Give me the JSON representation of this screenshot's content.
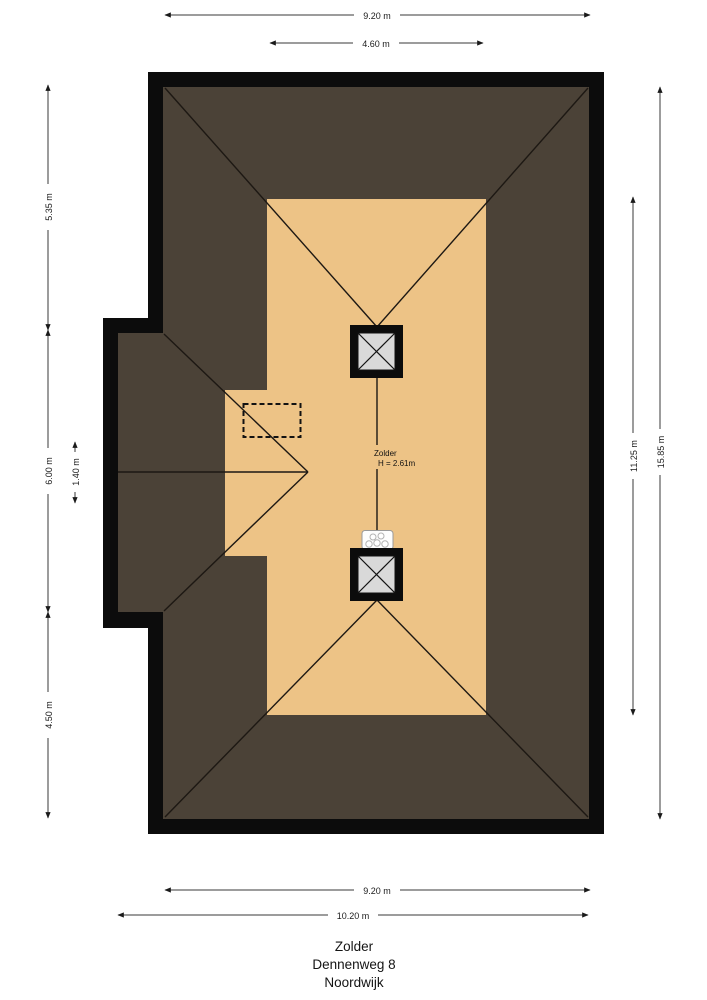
{
  "palette": {
    "roof_color": "#4b4237",
    "floor_color": "#edc386",
    "wall_color": "#0c0c0c",
    "chimney_color": "#d9d9d9",
    "dim_line_color": "#3a3a3a",
    "background_color": "#ffffff"
  },
  "dimensions": {
    "top": [
      {
        "label": "9.20 m"
      },
      {
        "label": "4.60 m"
      }
    ],
    "left": [
      {
        "label": "5.35 m"
      },
      {
        "label": "6.00 m"
      },
      {
        "label": "1.40 m"
      },
      {
        "label": "4.50 m"
      }
    ],
    "right": [
      {
        "label": "11.25 m"
      },
      {
        "label": "15.85 m"
      }
    ],
    "bottom": [
      {
        "label": "9.20 m"
      },
      {
        "label": "10.20 m"
      }
    ]
  },
  "room_label": {
    "name": "Zolder",
    "height_text": "H = 2.61m"
  },
  "title_block": {
    "room": "Zolder",
    "street": "Dennenweg 8",
    "city": "Noordwijk"
  }
}
